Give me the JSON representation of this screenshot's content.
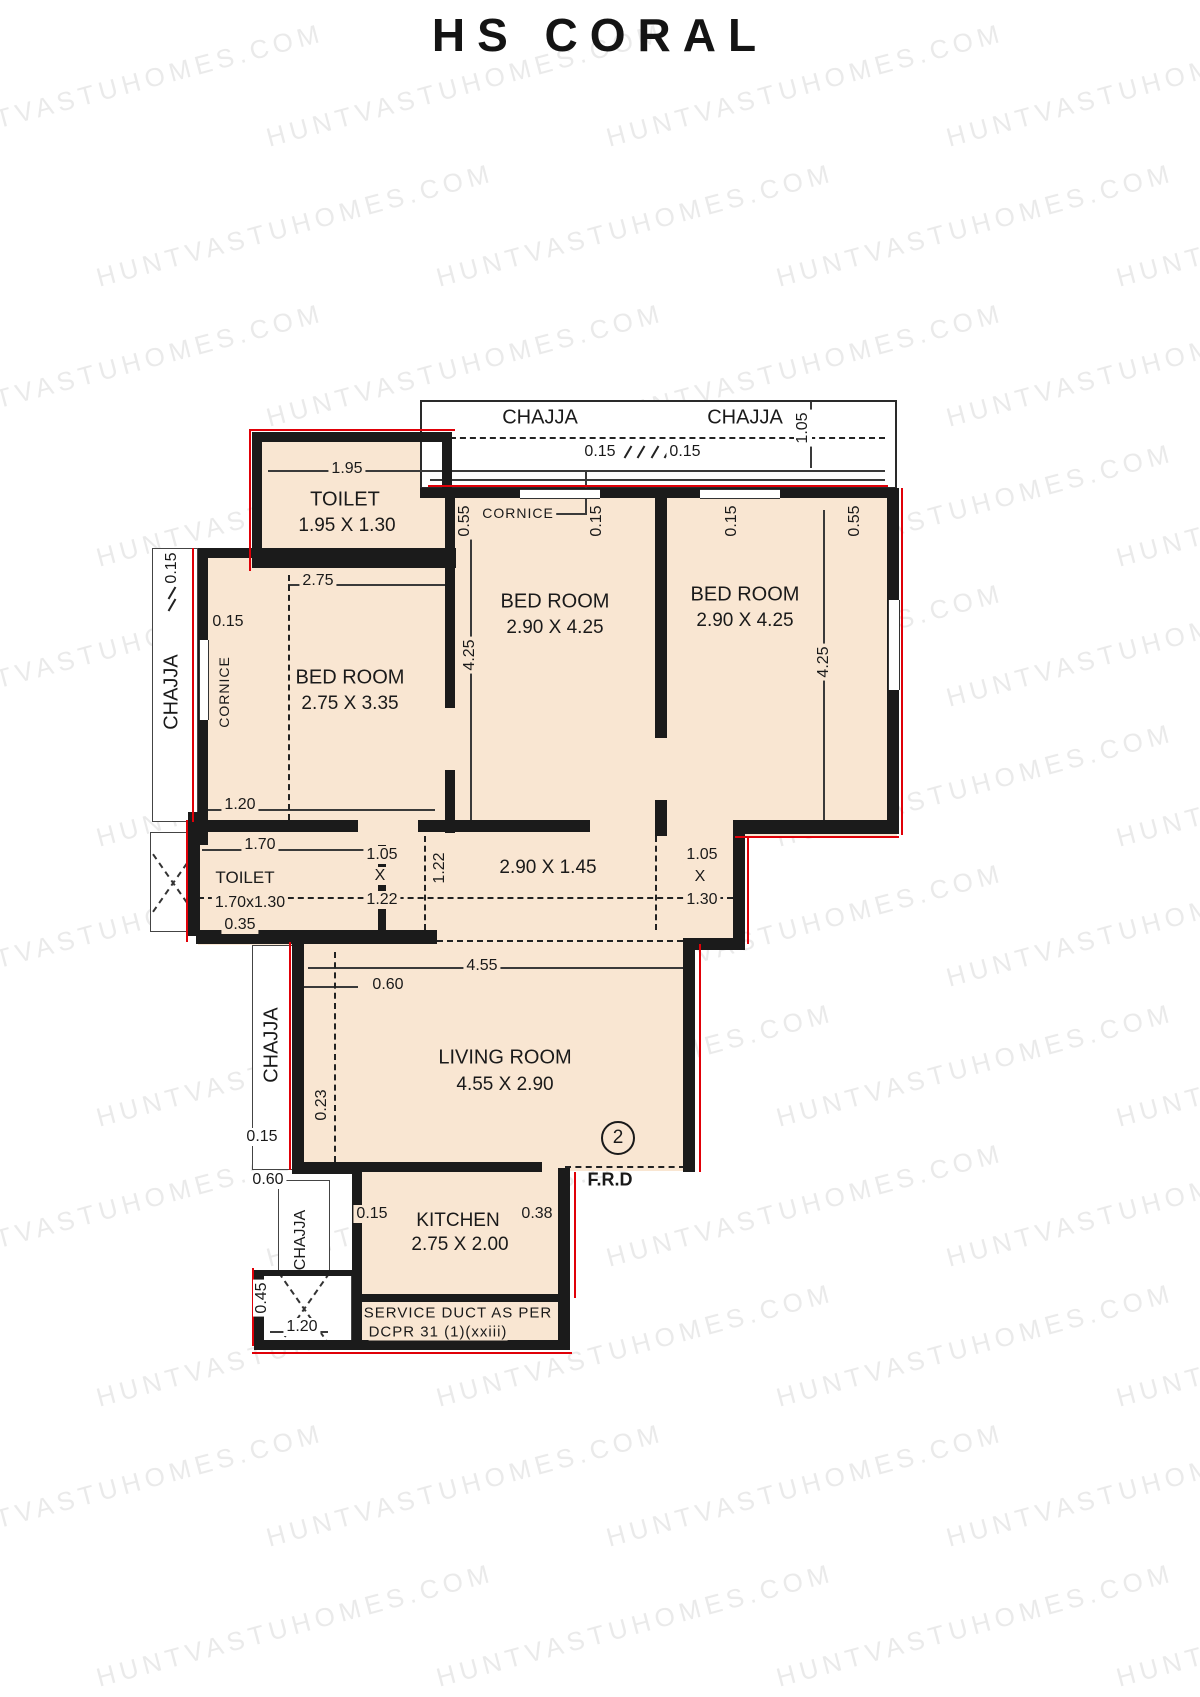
{
  "title": "HS CORAL",
  "watermark": {
    "text": "HUNTVASTUHOMES.COM"
  },
  "colors": {
    "room_fill": "#f9e6d2",
    "wall": "#1b1b1b",
    "red_accent": "#e00008",
    "watermark": "#d9d9d9"
  },
  "rooms": {
    "toilet_top": {
      "label": "TOILET",
      "size": "1.95 X 1.30"
    },
    "bed_left": {
      "label": "BED ROOM",
      "size": "2.75 X 3.35"
    },
    "bed_mid": {
      "label": "BED ROOM",
      "size": "2.90 X 4.25"
    },
    "bed_right": {
      "label": "BED ROOM",
      "size": "2.90 X 4.25"
    },
    "toilet_small": {
      "label": "TOILET",
      "size": "1.70x1.30"
    },
    "living": {
      "label": "LIVING  ROOM",
      "size": "4.55 X 2.90"
    },
    "kitchen": {
      "label": "KITCHEN",
      "size": "2.75 X 2.00"
    },
    "passage": {
      "size": "2.90 X 1.45"
    }
  },
  "labels": {
    "chajja": "CHAJJA",
    "cornice": "CORNICE",
    "frd": "F.R.D",
    "door_no": "2",
    "service1": "SERVICE DUCT AS PER",
    "service2": "DCPR 31 (1)(xxiii)"
  },
  "dims": {
    "d015": "0.15",
    "d023": "0.23",
    "d035": "0.35",
    "d038": "0.38",
    "d045": "0.45",
    "d055": "0.55",
    "d060": "0.60",
    "d105": "1.05",
    "d120": "1.20",
    "d122": "1.22",
    "d130": "1.30",
    "d170": "1.70",
    "d195": "1.95",
    "d275": "2.75",
    "d425": "4.25",
    "d455": "4.55",
    "x": "X"
  }
}
